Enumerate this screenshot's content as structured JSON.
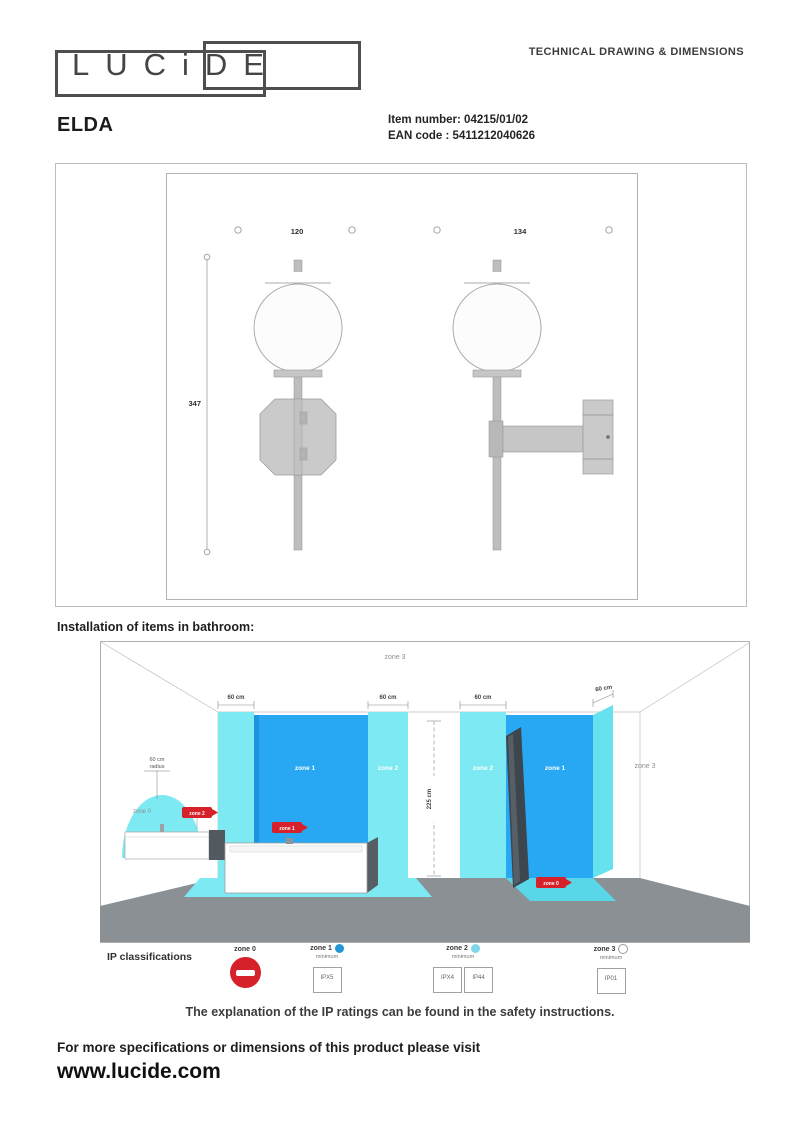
{
  "header": {
    "logo": "LUCiDE",
    "doc_title": "TECHNICAL DRAWING & DIMENSIONS"
  },
  "product": {
    "name": "ELDA",
    "item_label": "Item number:",
    "item_value": "04215/01/02",
    "ean_label": "EAN code :",
    "ean_value": "5411212040626"
  },
  "drawing": {
    "front_width": "120",
    "side_depth": "134",
    "height": "347"
  },
  "bathroom": {
    "heading": "Installation of items in bathroom:",
    "zone0": "zone 0",
    "zone1": "zone 1",
    "zone2": "zone 2",
    "zone3": "zone 3",
    "sixty": "60 cm",
    "radius_word": "radius",
    "height": "225 cm",
    "badge_basin": "zone 2",
    "badge_bath": "zone 1",
    "badge_shower": "zone 0"
  },
  "legend": {
    "title": "IP classifications",
    "zone0": {
      "label": "zone 0"
    },
    "zone1": {
      "label": "zone 1",
      "min": "minimum",
      "ip": "IPX5"
    },
    "zone2": {
      "label": "zone 2",
      "min": "minimum",
      "ip1": "IPX4",
      "ip2": "IP44"
    },
    "zone3": {
      "label": "zone 3",
      "min": "minimum",
      "ip": "IP01"
    },
    "note": "The explanation of the IP ratings can be found in the safety instructions."
  },
  "footer": {
    "line": "For more specifications or dimensions of this product please visit",
    "url": "www.lucide.com"
  },
  "colors": {
    "zone1_blue": "#28a8f2",
    "zone2_cyan": "#7de9f2",
    "badge_red": "#d6212a",
    "floor_gray": "#8b9095"
  }
}
